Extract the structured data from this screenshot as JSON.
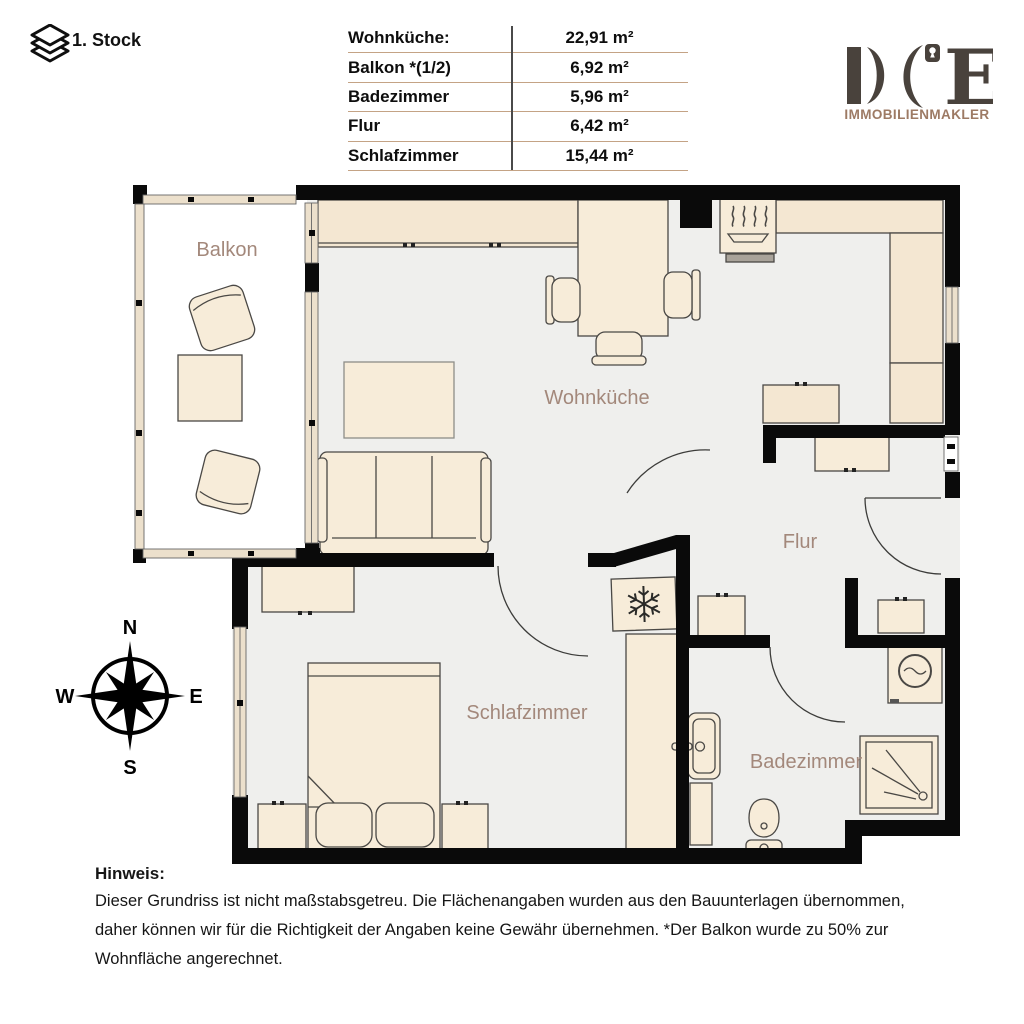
{
  "header": {
    "floor_label": "1. Stock"
  },
  "area_table": {
    "rows": [
      {
        "label": "Wohnküche:",
        "value": "22,91 m²"
      },
      {
        "label": "Balkon *(1/2)",
        "value": "6,92 m²"
      },
      {
        "label": "Badezimmer",
        "value": "5,96 m²"
      },
      {
        "label": "Flur",
        "value": "6,42 m²"
      },
      {
        "label": "Schlafzimmer",
        "value": "15,44 m²"
      }
    ]
  },
  "logo": {
    "name": "DCE",
    "letter_e": "E",
    "subtitle": "IMMOBILIENMAKLER"
  },
  "compass": {
    "n": "N",
    "e": "E",
    "s": "S",
    "w": "W"
  },
  "floorplan": {
    "rooms": [
      {
        "name": "balkon",
        "label": "Balkon"
      },
      {
        "name": "wohnkueche",
        "label": "Wohnküche"
      },
      {
        "name": "flur",
        "label": "Flur"
      },
      {
        "name": "schlafzimmer",
        "label": "Schlafzimmer"
      },
      {
        "name": "badezimmer",
        "label": "Badezimmer"
      }
    ]
  },
  "notice": {
    "title": "Hinweis:",
    "lines": [
      "Dieser Grundriss ist nicht maßstabsgetreu. Die Flächenangaben wurden aus den Bauunterlagen übernommen,",
      "daher können wir für die Richtigkeit der Angaben keine Gewähr übernehmen. *Der Balkon wurde zu 50% zur",
      "Wohnfläche angerechnet."
    ]
  },
  "colors": {
    "wall": "#0a0a0a",
    "floor": "#efefed",
    "furniture": "#f7ecd9",
    "counter": "#f4e7d2",
    "window_frame": "#ece0cc",
    "room_label": "#a3887b",
    "logo_dark": "#49423c",
    "logo_brown": "#9d7a64",
    "table_divider_tan": "#c4a385",
    "table_divider_gray": "#4a4a4a"
  }
}
